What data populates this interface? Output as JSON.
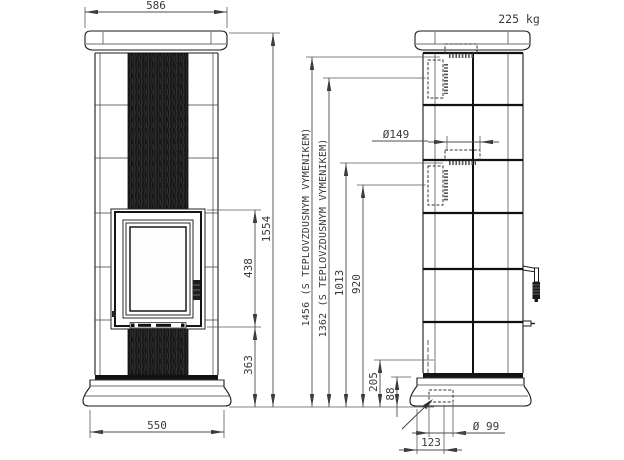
{
  "drawing": {
    "title_weight": "225 kg",
    "front": {
      "width_top": "586",
      "width_bottom": "550",
      "height_total": "1554",
      "door_height": "438",
      "base_height": "363"
    },
    "flue_heights": {
      "top_with_exchanger": "1456 (S TEPLOVZDUSNYM VYMENIKEM)",
      "rear_with_exchanger": "1362 (S TEPLOVZDUSNYM VYMENIKEM)",
      "top_standard": "1013",
      "rear_standard": "920",
      "air_inlet_center": "205",
      "base_edge": "88"
    },
    "flue": {
      "diameter": "Ø149"
    },
    "air_inlet": {
      "diameter": "Ø 99",
      "offset_from_rear": "123"
    }
  }
}
